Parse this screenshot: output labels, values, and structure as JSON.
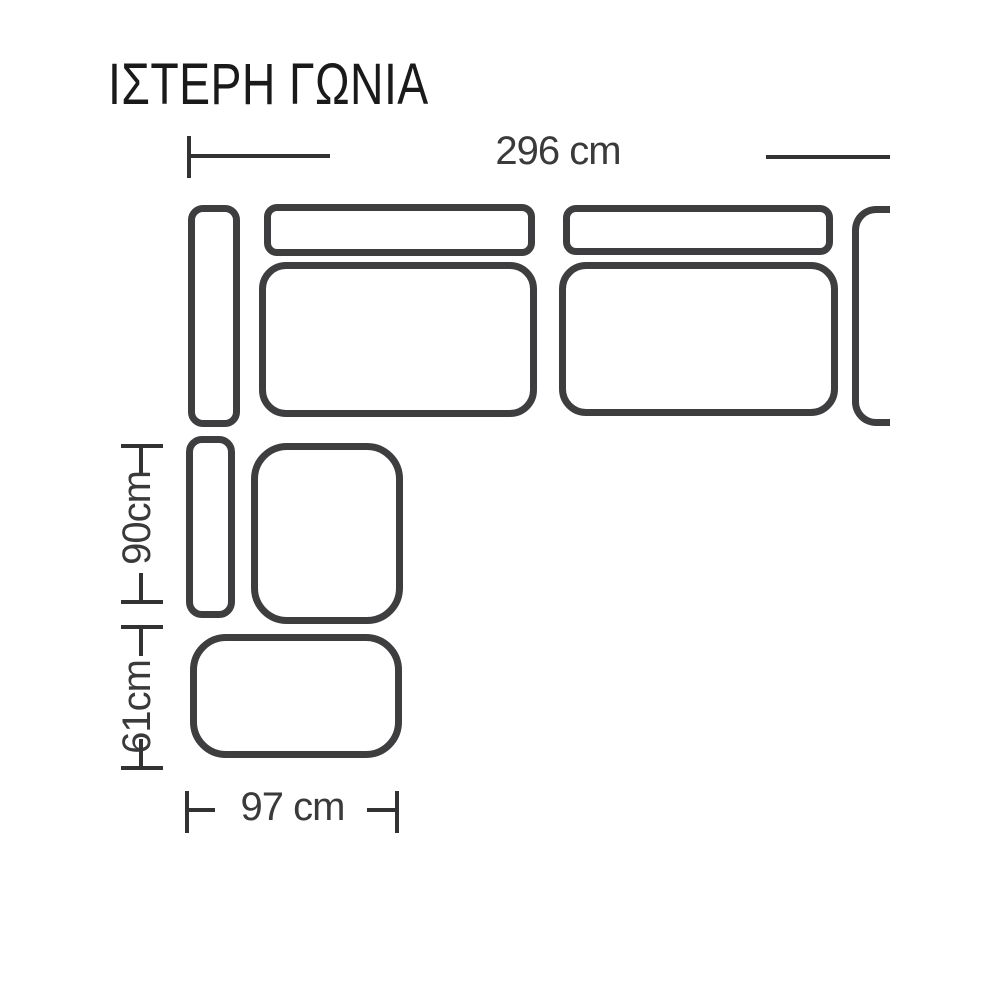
{
  "title": "ΙΣΤΕΡΗ ΓΩΝΙΑ",
  "diagram_type": "corner-sofa-dimension-drawing",
  "dimensions": {
    "top": "296 cm",
    "left_upper": "90cm",
    "left_lower": "61cm",
    "bottom": "97 cm"
  },
  "pieces": [
    {
      "name": "armrest-top-left"
    },
    {
      "name": "backrest-cushion-1"
    },
    {
      "name": "seat-cushion-1"
    },
    {
      "name": "backrest-cushion-2"
    },
    {
      "name": "seat-cushion-2"
    },
    {
      "name": "armrest-right-clipped"
    },
    {
      "name": "armrest-bottom-left"
    },
    {
      "name": "corner-seat"
    },
    {
      "name": "ottoman"
    }
  ],
  "colors": {
    "background": "#ffffff",
    "outline": "#3e3e40",
    "dimension_line": "#323234",
    "dimension_text": "#3a3a3c",
    "title_text": "#1a1a1a"
  }
}
